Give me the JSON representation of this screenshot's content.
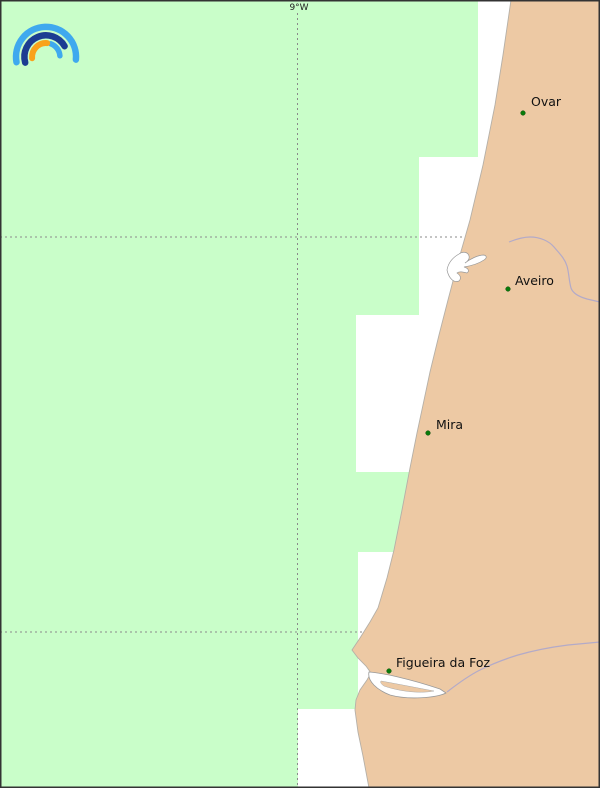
{
  "map": {
    "type": "coastal-forecast-coverage-map",
    "meridian_label": "9°W",
    "cities": [
      {
        "name": "Ovar"
      },
      {
        "name": "Aveiro"
      },
      {
        "name": "Mira"
      },
      {
        "name": "Figueira da Foz"
      }
    ],
    "colors": {
      "coverage_green": "#c9fec9",
      "land": "#edc9a4",
      "sea_white": "#ffffff",
      "grid": "#8a8a8a",
      "river": "#b3aac8",
      "water_outline": "#999999",
      "marker": "#0a7a0a",
      "coast_edge": "#b5b0a8"
    },
    "logo": {
      "icon": "rainbow-arcs-logo",
      "colors": {
        "outer_arc": "#3fa9ee",
        "middle_arc": "#1c3c92",
        "inner_left_arc": "#f9a21b",
        "inner_right_arc": "#3fa9ee"
      }
    }
  }
}
